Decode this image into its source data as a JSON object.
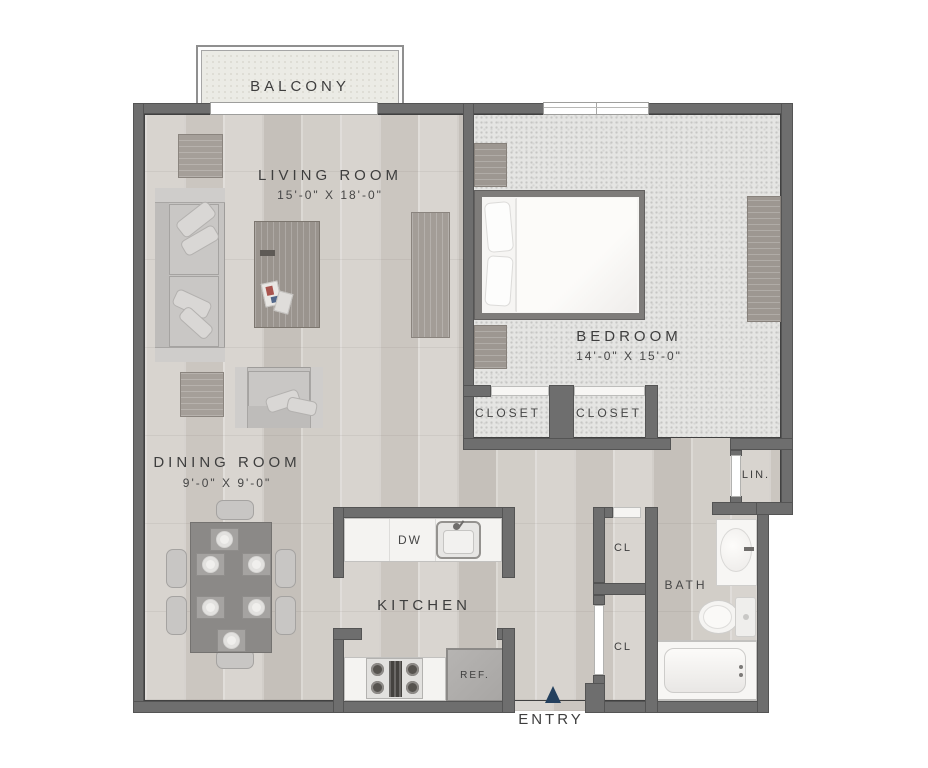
{
  "labels": {
    "balcony": "BALCONY",
    "living_room": "LIVING ROOM",
    "living_room_dims": "15'-0\" X 18'-0\"",
    "bedroom": "BEDROOM",
    "bedroom_dims": "14'-0\" X 15'-0\"",
    "dining_room": "DINING ROOM",
    "dining_room_dims": "9'-0\" X 9'-0\"",
    "kitchen": "KITCHEN",
    "bath": "BATH",
    "closet_bedroom_left": "CLOSET",
    "closet_bedroom_right": "CLOSET",
    "linen_closet": "LIN.",
    "hall_closet_upper": "CL",
    "hall_closet_lower": "CL",
    "dishwasher": "DW",
    "refrigerator": "REF.",
    "entry": "ENTRY"
  },
  "colors": {
    "wall": "#6e6e6e",
    "wood_floor": "#d5d1cb",
    "carpet": "#e5e5e3",
    "counter": "#f4f3f1",
    "balcony_floor": "#ebebe5",
    "entry_arrow": "#24405e",
    "label_text": "#3e3e3e"
  }
}
